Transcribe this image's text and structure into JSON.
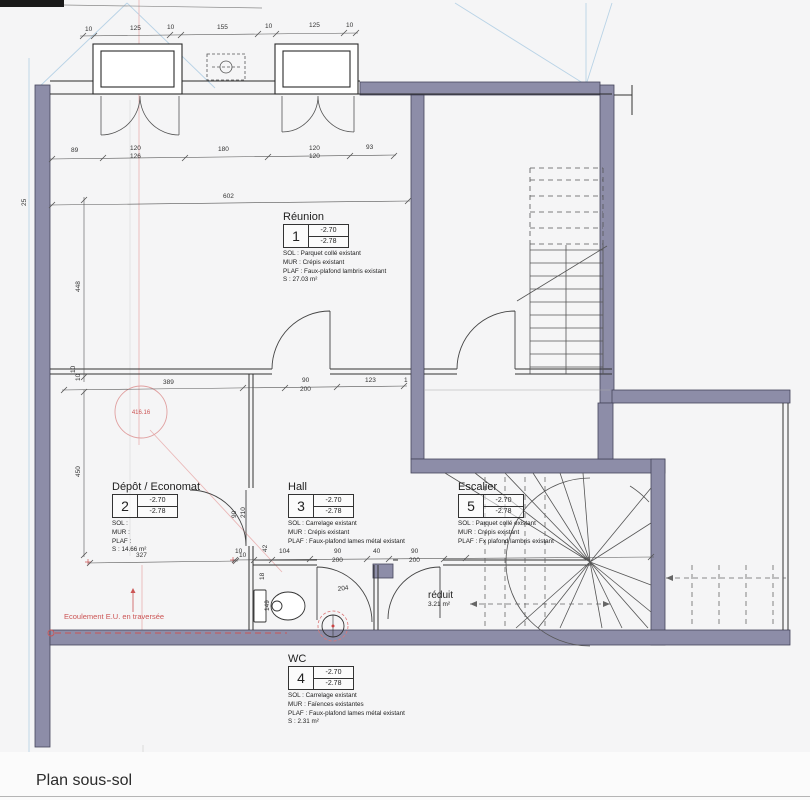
{
  "title": "Plan sous-sol",
  "rooms": {
    "reunion": {
      "name": "Réunion",
      "num": "1",
      "lvl1": "-2.70",
      "lvl2": "-2.78",
      "sol": "SOL : Parquet collé existant",
      "mur": "MUR : Crépis existant",
      "plaf": "PLAF : Faux-plafond lambris existant",
      "surf": "S :   27.03 m²"
    },
    "depot": {
      "name": "Dépôt / Economat",
      "num": "2",
      "lvl1": "-2.70",
      "lvl2": "-2.78",
      "sol": "SOL :",
      "mur": "MUR :",
      "plaf": "PLAF :",
      "surf": "S :   14.66 m²"
    },
    "hall": {
      "name": "Hall",
      "num": "3",
      "lvl1": "-2.70",
      "lvl2": "-2.78",
      "sol": "SOL : Carrelage existant",
      "mur": "MUR : Crépis existant",
      "plaf": "PLAF : Faux-plafond lames métal existant"
    },
    "wc": {
      "name": "WC",
      "num": "4",
      "lvl1": "-2.70",
      "lvl2": "-2.78",
      "sol": "SOL : Carrelage existant",
      "mur": "MUR : Faïences existantes",
      "plaf": "PLAF : Faux-plafond lames métal existant",
      "surf": "S :   2.31 m²"
    },
    "escalier": {
      "name": "Escalier",
      "num": "5",
      "lvl1": "-2.70",
      "lvl2": "-2.78",
      "sol": "SOL : Parquet collé existant",
      "mur": "MUR : Crépis existant",
      "plaf": "PLAF : Fx plafond lambris existant"
    },
    "reduit": {
      "name": "réduit",
      "surf": "3.21 m²"
    }
  },
  "annotations": {
    "ecoulement": "Ecoulement E.U. en traversée",
    "circle_value": "416.16"
  },
  "dims": {
    "top": [
      "10",
      "125",
      "10",
      "155",
      "10",
      "125",
      "10"
    ],
    "row2": [
      "89",
      "120",
      "126",
      "180",
      "120",
      "120",
      "93"
    ],
    "total": "602",
    "left_25": "25",
    "left_448": "448",
    "left_10": "10",
    "left_450": "450",
    "depot_width": "327",
    "depot_width_10": "10",
    "mid": [
      "389",
      "90",
      "200",
      "123",
      "1",
      "10"
    ],
    "depot_door": [
      "90",
      "210"
    ],
    "bottom": [
      "10",
      "42",
      "104",
      "90",
      "200",
      "40",
      "90",
      "200"
    ],
    "wc": [
      "204",
      "149",
      "18"
    ]
  },
  "colors": {
    "wall": "#8d8da8",
    "annotation_red": "#cc5555",
    "construction_blue": "#b9d3e6",
    "construction_pink": "#eab8b8"
  }
}
